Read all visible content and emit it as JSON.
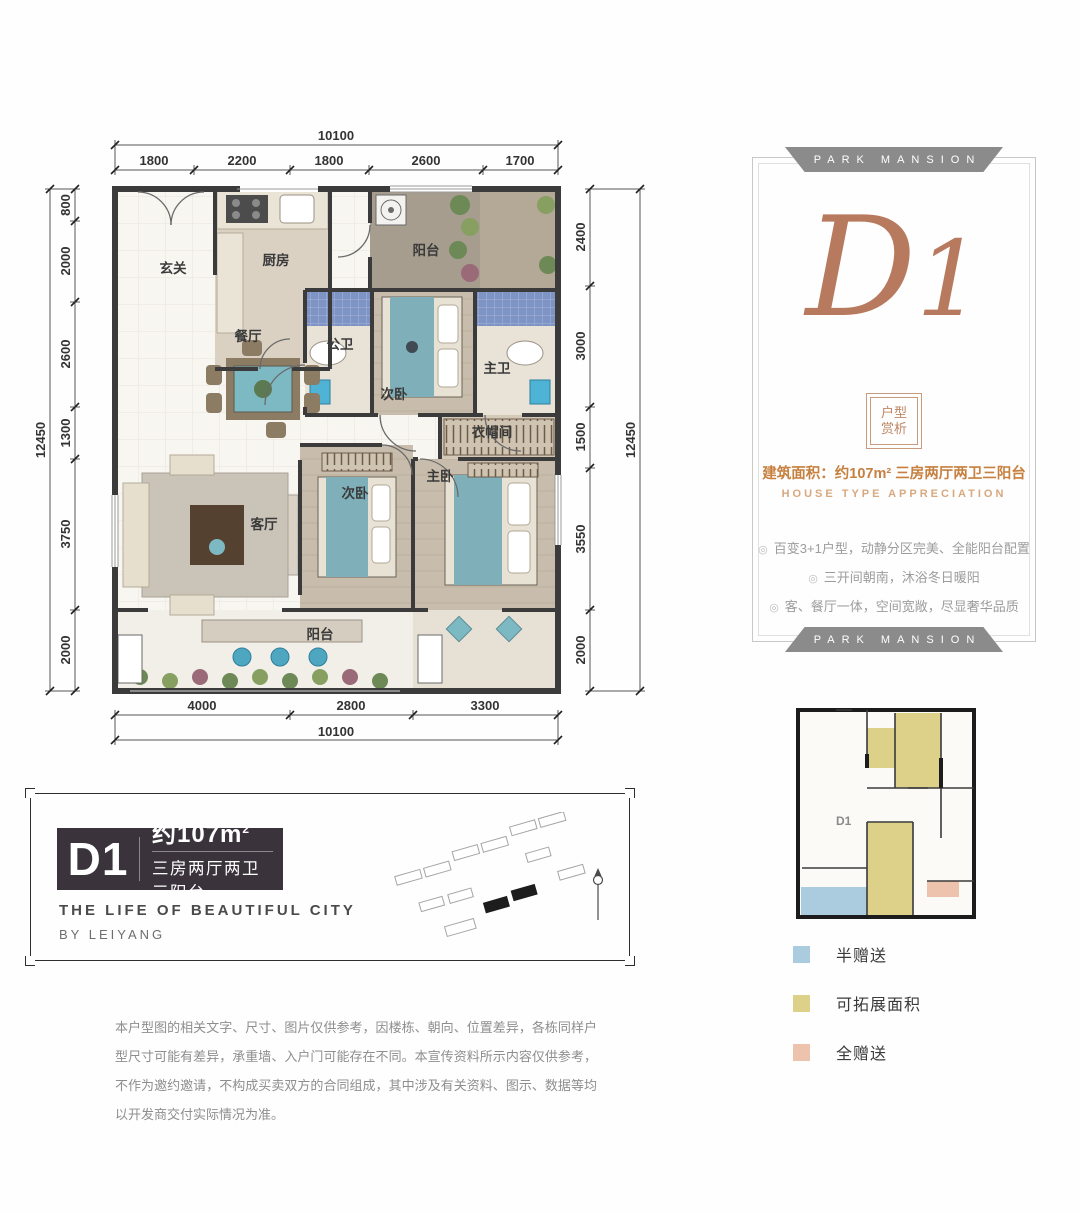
{
  "floorplan": {
    "dims": {
      "top": {
        "total": "10100",
        "segments": [
          "1800",
          "2200",
          "1800",
          "2600",
          "1700"
        ]
      },
      "bottom": {
        "total": "10100",
        "segments": [
          "4000",
          "2800",
          "3300"
        ]
      },
      "left": {
        "total": "12450",
        "segments": [
          "800",
          "2000",
          "2600",
          "1300",
          "3750",
          "2000"
        ]
      },
      "right": {
        "total": "12450",
        "segments": [
          "2400",
          "3000",
          "1500",
          "3550",
          "2000"
        ]
      }
    },
    "rooms": [
      {
        "label": "玄关"
      },
      {
        "label": "厨房"
      },
      {
        "label": "阳台"
      },
      {
        "label": "公卫"
      },
      {
        "label": "次卧"
      },
      {
        "label": "主卫"
      },
      {
        "label": "餐厅"
      },
      {
        "label": "衣帽间"
      },
      {
        "label": "客厅"
      },
      {
        "label": "次卧"
      },
      {
        "label": "主卧"
      },
      {
        "label": "阳台"
      }
    ]
  },
  "d1_card": {
    "banner_top": "PARK MANSION",
    "banner_bottom": "PARK MANSION",
    "title_d": "D",
    "title_1": "1",
    "badge_line1": "户型",
    "badge_line2": "赏析",
    "area_label": "建筑面积：",
    "area_value": "约107m²",
    "area_desc": " 三房两厅两卫三阳台",
    "subtitle_en": "HOUSE TYPE  APPRECIATION",
    "bullet": "◎",
    "features": [
      "百变3+1户型，动静分区完美、全能阳台配置",
      "三开间朝南，沐浴冬日暖阳",
      "客、餐厅一体，空间宽敞，尽显奢华品质"
    ]
  },
  "info_box": {
    "plaque_code": "D1",
    "area_value": "约107m",
    "area_sup": "2",
    "plaque_subtitle": "三房两厅两卫三阳台",
    "tagline_line1": "THE  LIFE  OF  BEAUTIFUL  CITY",
    "tagline_line2": "BY  LEIYANG"
  },
  "mini_plan": {
    "unit_label": "D1",
    "legend": [
      {
        "label": "半赠送",
        "color": "#abccdf"
      },
      {
        "label": "可拓展面积",
        "color": "#ddd089"
      },
      {
        "label": "全赠送",
        "color": "#eec3ae"
      }
    ]
  },
  "disclaimer": "本户型图的相关文字、尺寸、图片仅供参考，因楼栋、朝向、位置差异，各栋同样户型尺寸可能有差异，承重墙、入户门可能存在不同。本宣传资料所示内容仅供参考，不作为邀约邀请，不构成买卖双方的合同组成，其中涉及有关资料、图示、数据等均以开发商交付实际情况为准。",
  "colors": {
    "copper": "#b87a5e",
    "banner_gray": "#8b8b8b",
    "plaque_dark": "#3a333c",
    "wall": "#3b3b3b",
    "bath_tile": "#7e94c5",
    "bed_teal": "#7fb0ba"
  }
}
